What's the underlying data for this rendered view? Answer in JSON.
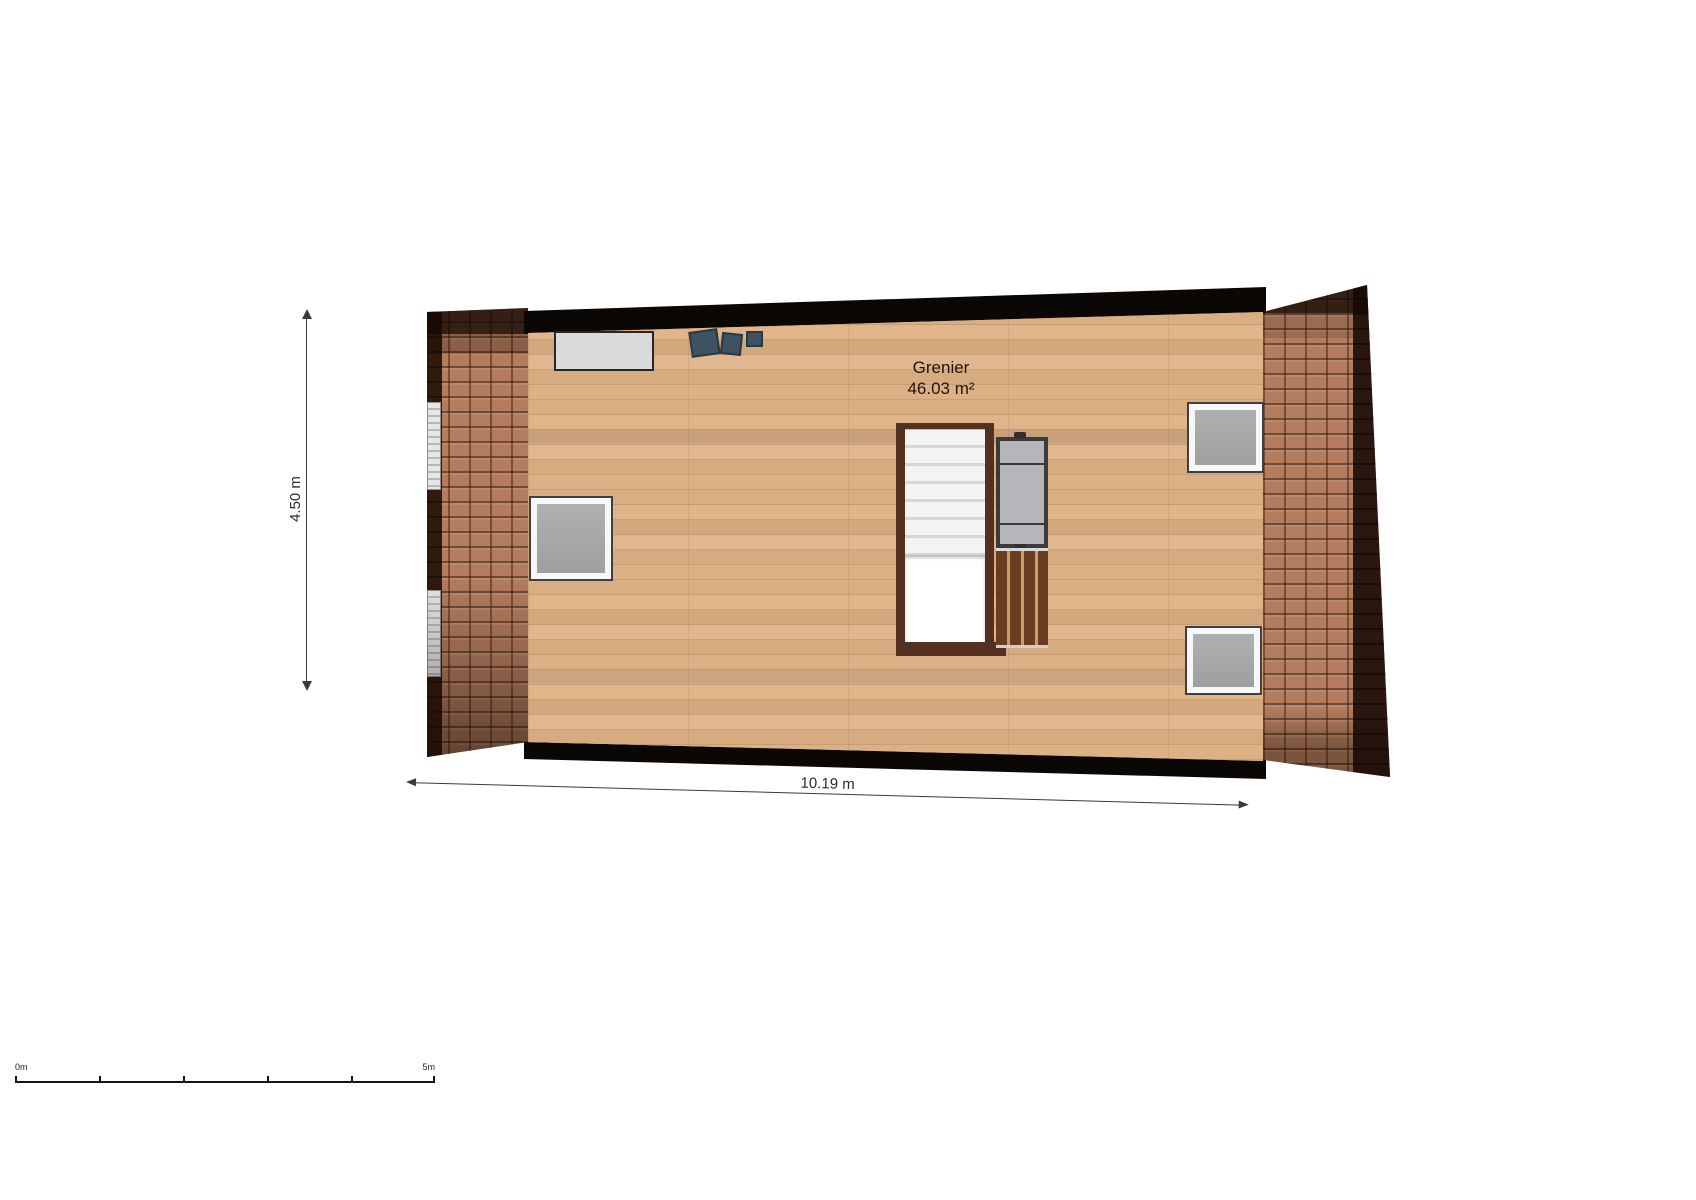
{
  "plan": {
    "room": {
      "name": "Grenier",
      "area": "46.03 m²"
    },
    "dimensions": {
      "height": "4.50 m",
      "width": "10.19 m"
    },
    "scale_bar": {
      "start": "0m",
      "end": "5m"
    },
    "colors": {
      "background": "#ffffff",
      "wall": "#0b0705",
      "wood_floor": "#d4a97e",
      "roof_tiles": "#b27c5d",
      "roof_tiles_dark_edge": "#2c1710",
      "stair_frame": "#53301f",
      "stair_treads": "#f3f3f5",
      "railing": "#3b3b3b",
      "wood_steps": "#6b3d20",
      "skylight_glass": "#a8a8a8",
      "panel_gray": "#dadada",
      "cushion_blue": "#3d5362",
      "dimension_line": "#3a3a3a",
      "label_text": "#20140b"
    }
  }
}
